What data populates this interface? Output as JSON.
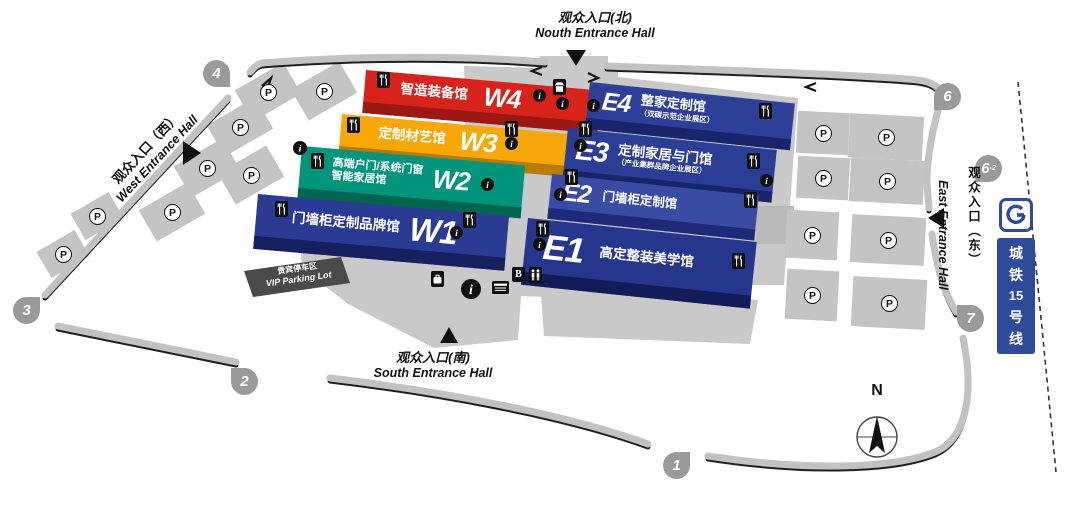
{
  "halls": [
    {
      "letter": "W4",
      "name": "智造装备馆",
      "color": "#d7231c"
    },
    {
      "letter": "W3",
      "name": "定制材艺馆",
      "color": "#f7a708"
    },
    {
      "letter": "W2",
      "name": "高端户门/系统门窗",
      "name2": "智能家居馆",
      "color": "#00947c"
    },
    {
      "letter": "W1",
      "name": "门墙柜定制品牌馆",
      "color": "#2b3a92"
    },
    {
      "letter": "E4",
      "name": "整家定制馆",
      "sub": "（双碳示范企业展区）",
      "color": "#2e3f97"
    },
    {
      "letter": "E3",
      "name": "定制家居与门馆",
      "sub": "（产业集群品牌企业展区）",
      "color": "#2c3d95"
    },
    {
      "letter": "E2",
      "name": "门墙柜定制馆",
      "color": "#3a4ba3"
    },
    {
      "letter": "E1",
      "name": "高定整装美学馆",
      "color": "#26368c"
    }
  ],
  "entrances": {
    "north": {
      "zh": "观众入口(北)",
      "en": "Nouth Entrance Hall"
    },
    "south": {
      "zh": "观众入口(南)",
      "en": "South Entrance Hall"
    },
    "west": {
      "zh": "观众入口（西）",
      "en": "West Entrance Hall"
    },
    "east": {
      "zh": "观众入口（东）",
      "en": "East Entrance Hall"
    }
  },
  "gates": {
    "g1": "1",
    "g2": "2",
    "g3": "3",
    "g4": "4",
    "g6": "6",
    "g6b": "6",
    "g6b_sup": "-2",
    "g7": "7"
  },
  "parking": {
    "symbol": "P",
    "vip_zh": "贵宾停车区",
    "vip_en": "VIP Parking Lot"
  },
  "metro": {
    "char1": "城",
    "char2": "铁",
    "char3": "15",
    "char4": "号",
    "char5": "线",
    "full": "城铁15号线",
    "color": "#2e4a9a"
  },
  "icons": {
    "atm_label": "B",
    "restaurant": "fork-knife",
    "info": "i",
    "restroom": "two-persons",
    "locker": "briefcase",
    "shop": "kiosk",
    "service": "counter"
  },
  "compass": {
    "label": "N"
  }
}
